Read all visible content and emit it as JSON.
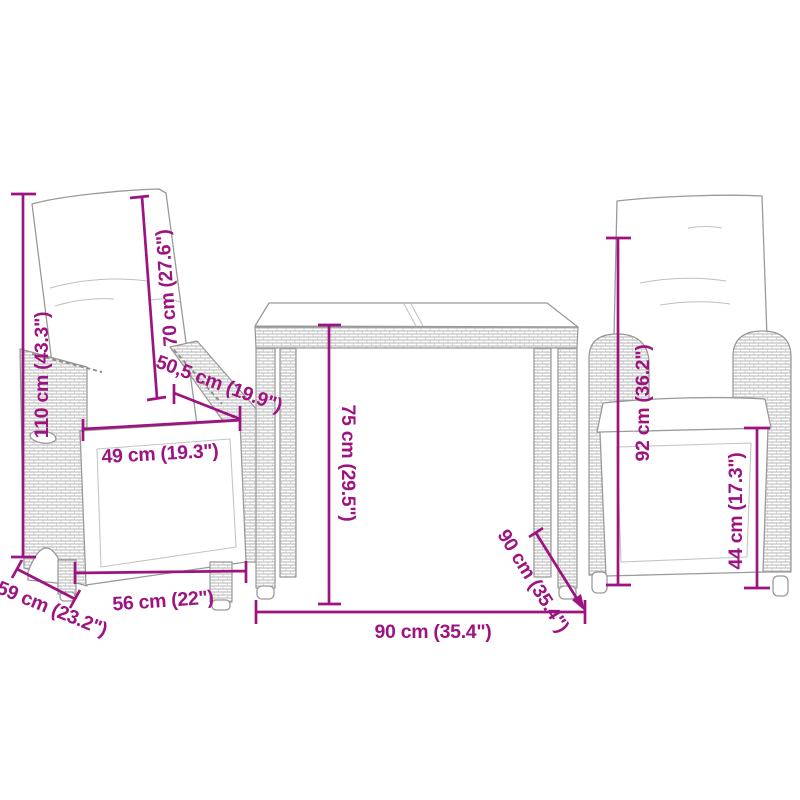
{
  "colors": {
    "dimension_accent": "#9D1380",
    "line_art_gray": "#9A9A9A"
  },
  "dimensions": {
    "left_chair": {
      "total_height": "110 cm (43.3\")",
      "backrest_height": "70 cm (27.6\")",
      "seat_depth": "50,5 cm (19.9\")",
      "seat_width": "49 cm (19.3\")",
      "width": "56 cm (22\")",
      "depth": "59 cm (23.2\")"
    },
    "table": {
      "height": "75 cm (29.5\")",
      "width": "90 cm (35.4\")",
      "depth": "90 cm (35.4\")"
    },
    "right_chair": {
      "backrest_height": "92 cm (36.2\")",
      "seat_height": "44 cm (17.3\")"
    }
  }
}
